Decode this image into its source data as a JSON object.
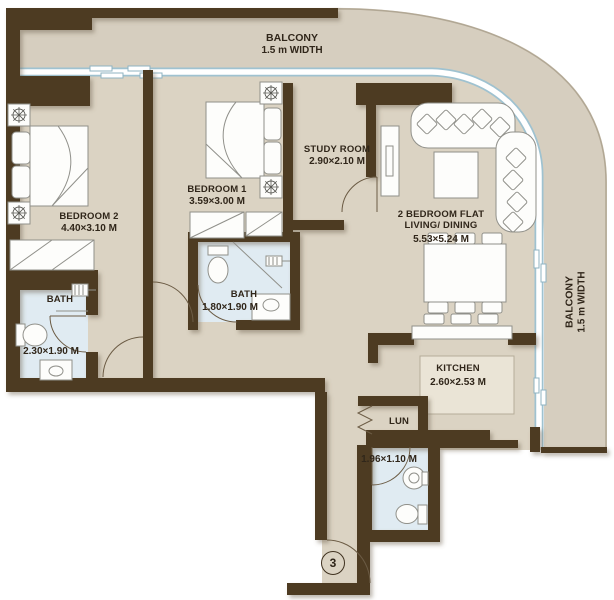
{
  "plan": {
    "balcony_top": {
      "name": "BALCONY",
      "width_label": "1.5 m WIDTH"
    },
    "balcony_right": {
      "name": "BALCONY",
      "width_label": "1.5 m WIDTH"
    },
    "rooms": {
      "bedroom2": {
        "name": "BEDROOM 2",
        "dims": "4.40×3.10 M"
      },
      "bedroom1": {
        "name": "BEDROOM 1",
        "dims": "3.59×3.00 M"
      },
      "study": {
        "name": "STUDY ROOM",
        "dims": "2.90×2.10 M"
      },
      "living": {
        "line1": "2 BEDROOM FLAT",
        "line2": "LIVING/ DINING",
        "dims": "5.53×5.24 M"
      },
      "bath_master": {
        "name": "BATH",
        "dims": "2.30×1.90 M"
      },
      "bath_shared": {
        "name": "BATH",
        "dims": "1.80×1.90 M"
      },
      "kitchen": {
        "name": "KITCHEN",
        "dims": "2.60×2.53 M"
      },
      "laundry": {
        "name": "LUN",
        "dims": "1.96×1.10 M"
      },
      "entry": {
        "door_number": "3"
      }
    },
    "colors": {
      "wall": "#4e3a24",
      "floor": "#dbd3c3",
      "balcony_floor": "#d6cebf",
      "bath_floor": "#e0ebf2",
      "kitchen_counter": "#eae4d6",
      "glass": "#9fc2d0",
      "text": "#30261a"
    }
  }
}
